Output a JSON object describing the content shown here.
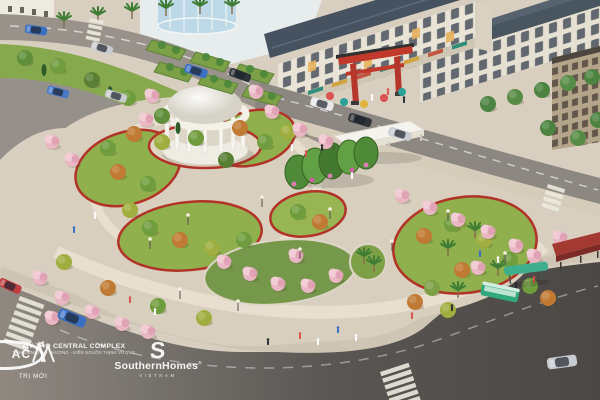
{
  "image": {
    "kind": "3d-aerial-architectural-rendering",
    "subject": "Landscaped oval central park with white rotunda, cherry-blossom trees, topiary garden, red torii gate, shophouse blocks, surrounding boulevards with crosswalks, cars and a bus stop",
    "project_name": "MỸ THO CENTRAL COMPLEX"
  },
  "watermarks": {
    "left_logo": {
      "text": "AC",
      "subtext": "TRỊ MỚI"
    },
    "developer": {
      "logo": "m-monogram",
      "name": "MỸ THO CENTRAL COMPLEX",
      "tagline": "TÂM ĐIỂM GIAO THƯƠNG - KIẾN NGUỒN THỊNH VƯỢNG"
    },
    "agency": {
      "logo_letter": "S",
      "name": "SouthernHomes",
      "registered_mark": "®",
      "country": "VIETNAM"
    }
  },
  "scene": {
    "landmarks": [
      "white-domed-rotunda-pavilion",
      "topiary-arch-garden",
      "flat-roof-pavilion",
      "red-torii-gate",
      "shophouse-rows-with-slate-roofs",
      "glass-cylinder-building",
      "modern-corner-building",
      "cherry-blossom-trees",
      "palm-trees",
      "lawns-with-red-flower-borders",
      "zebra-crossings",
      "green-city-bus",
      "teal-bus-shelter",
      "red-canopy-walkway",
      "street-lamps",
      "pedestrians"
    ],
    "colors": {
      "pavement_cream": "#d9cfbe",
      "lawn_green": "#8fb04c",
      "flower_border_red": "#b23227",
      "canopy_pink": "#ecbcc8",
      "road_gray": "#8f8981",
      "asphalt_dark": "#4e4a47",
      "roof_slate": "#46525f",
      "torii_red": "#c0392b",
      "glass_blue": "#bdd8e6",
      "bus_teal": "#2fa87e",
      "walkway_canopy_red": "#a33a32"
    }
  }
}
